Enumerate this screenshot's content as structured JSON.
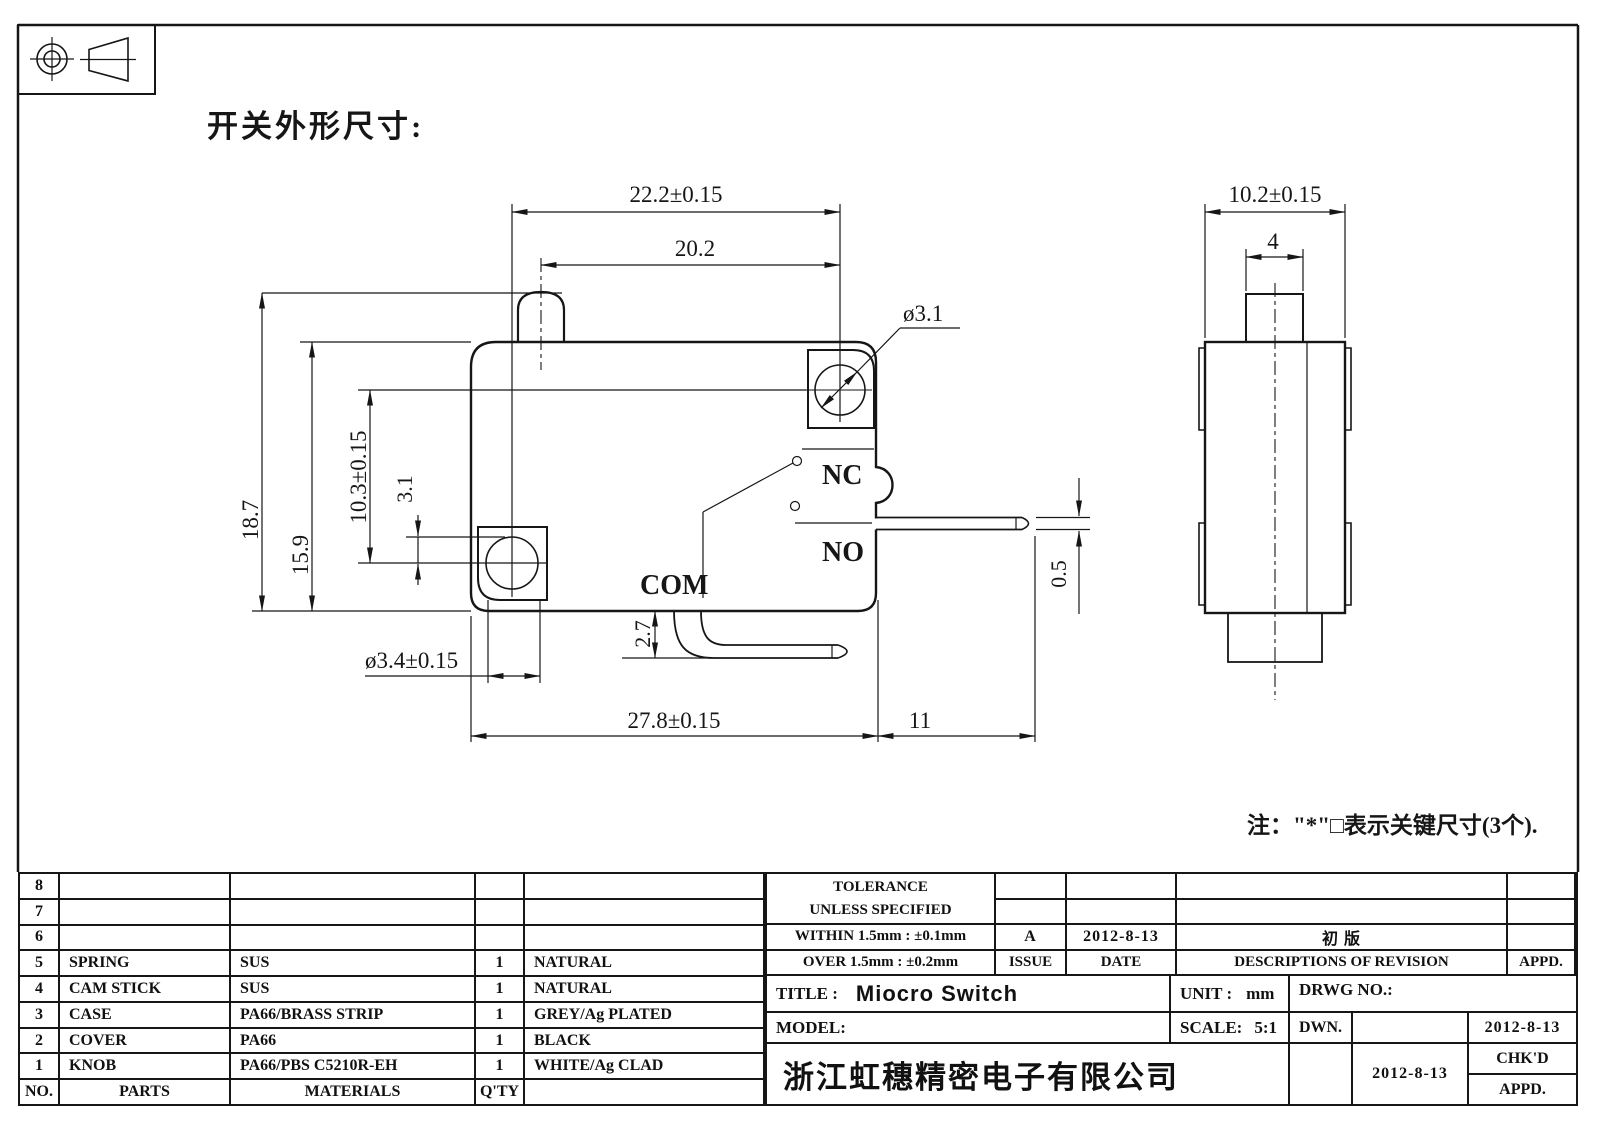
{
  "sheet": {
    "section_title": "开关外形尺寸:",
    "note": "注：\"*\"□表示关键尺寸(3个)."
  },
  "main_view": {
    "labels": {
      "nc": "NC",
      "no": "NO",
      "com": "COM"
    },
    "dims": {
      "hole_spacing_h": "22.2±0.15",
      "button_to_hole": "20.2",
      "height_overall": "18.7",
      "height_body": "15.9",
      "hole_spacing_v": "10.3±0.15",
      "hole_offset": "3.1",
      "hole_top_dia": "ø3.1",
      "hole_bottom_dia": "ø3.4±0.15",
      "com_drop": "2.7",
      "length_overall": "27.8±0.15",
      "terminal_ext": "11",
      "terminal_thickness": "0.5"
    }
  },
  "side_view": {
    "dims": {
      "width_overall": "10.2±0.15",
      "button_width": "4"
    }
  },
  "parts_table": {
    "header": {
      "no": "NO.",
      "part": "PARTS",
      "material": "MATERIALS",
      "qty": "Q'TY",
      "color": ""
    },
    "rows": [
      {
        "no": "8",
        "part": "",
        "material": "",
        "qty": "",
        "color": ""
      },
      {
        "no": "7",
        "part": "",
        "material": "",
        "qty": "",
        "color": ""
      },
      {
        "no": "6",
        "part": "",
        "material": "",
        "qty": "",
        "color": ""
      },
      {
        "no": "5",
        "part": "SPRING",
        "material": "SUS",
        "qty": "1",
        "color": "NATURAL"
      },
      {
        "no": "4",
        "part": "CAM STICK",
        "material": "SUS",
        "qty": "1",
        "color": "NATURAL"
      },
      {
        "no": "3",
        "part": "CASE",
        "material": "PA66/BRASS STRIP",
        "qty": "1",
        "color": "GREY/Ag PLATED"
      },
      {
        "no": "2",
        "part": "COVER",
        "material": "PA66",
        "qty": "1",
        "color": "BLACK"
      },
      {
        "no": "1",
        "part": "KNOB",
        "material": "PA66/PBS C5210R-EH",
        "qty": "1",
        "color": "WHITE/Ag CLAD"
      }
    ]
  },
  "title_block": {
    "tolerance_title_1": "TOLERANCE",
    "tolerance_title_2": "UNLESS  SPECIFIED",
    "within": "WITHIN 1.5mm : ±0.1mm",
    "over": "OVER 1.5mm : ±0.2mm",
    "issue_value": "A",
    "issue_label": "ISSUE",
    "date_value": "2012-8-13",
    "date_label": "DATE",
    "revision_desc": "初  版",
    "desc_label": "DESCRIPTIONS  OF  REVISION",
    "appd_label": "APPD.",
    "title_label": "TITLE :",
    "title_value": "Miocro Switch",
    "unit_label": "UNIT :",
    "unit_value": "mm",
    "drwg_label": "DRWG  NO.:",
    "model_label": "MODEL:",
    "scale_label": "SCALE:",
    "scale_value": "5:1",
    "company": "浙江虹穗精密电子有限公司",
    "dwn_label": "DWN.",
    "dwn_date": "2012-8-13",
    "chkd_label": "CHK'D",
    "chkd_date": "2012-8-13",
    "appd_row_label": "APPD."
  }
}
